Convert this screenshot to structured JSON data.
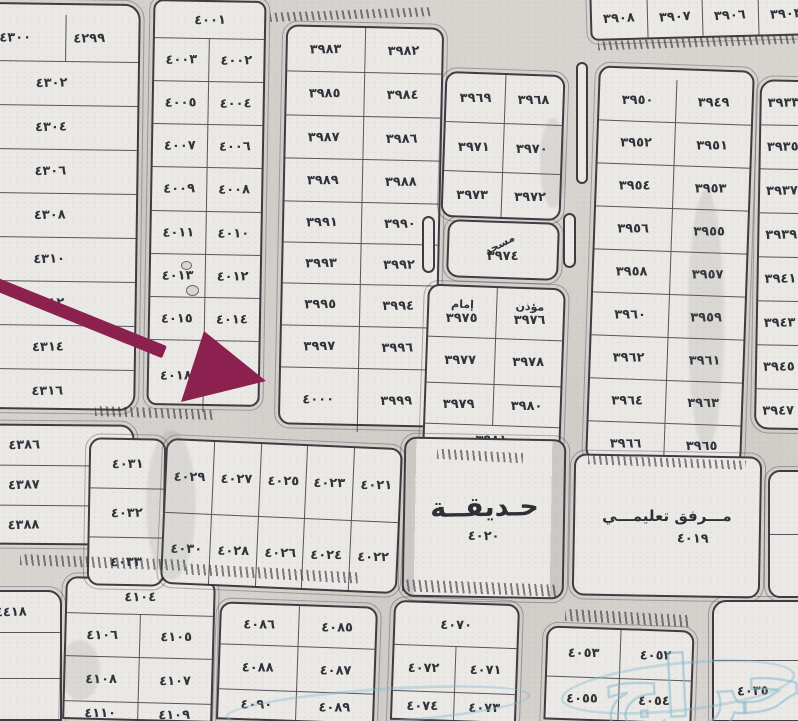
{
  "map": {
    "colors": {
      "paper": "#d8d5d1",
      "block_fill": "#ebe9e6",
      "line": "#3e3c42",
      "text": "#33323a",
      "arrow": "#8c2150",
      "watermark": "#85bccd"
    },
    "watermark": {
      "text": "حراج"
    },
    "arrow": {
      "line": {
        "x": -8,
        "y": 276,
        "len": 186,
        "w": 13,
        "deg": 22
      },
      "head_points": "204,331 181,402 266,381"
    },
    "blocks": [
      {
        "nm": "block-4300s-left",
        "x": -12,
        "y": 3,
        "w": 150,
        "h": 407,
        "tilt": 0.8,
        "pt": 10,
        "pr": 26,
        "r": "0 16px 16px 0",
        "rows": [
          {
            "h": 46,
            "c": [
              "٤٣٠٠",
              "٤٢٩٩"
            ]
          },
          {
            "h": 43,
            "c": [
              "٤٣٠٢"
            ]
          },
          {
            "h": 43,
            "c": [
              "٤٣٠٤"
            ]
          },
          {
            "h": 43,
            "c": [
              "٤٣٠٦"
            ]
          },
          {
            "h": 43,
            "c": [
              "٤٣٠٨"
            ]
          },
          {
            "h": 43,
            "c": [
              "٤٣١٠"
            ]
          },
          {
            "h": 43,
            "c": [
              "٤٣١٢"
            ]
          },
          {
            "h": 43,
            "c": [
              "٤٣١٤"
            ]
          },
          {
            "h": 43,
            "c": [
              "٤٣١٦"
            ]
          }
        ]
      },
      {
        "nm": "block-4380s-left",
        "x": -40,
        "y": 424,
        "w": 174,
        "h": 121,
        "pr": 46,
        "r": "0 14px 14px 0",
        "tilt": 0.5,
        "rows": [
          {
            "h": 39,
            "c": [
              "٤٣٨٦"
            ]
          },
          {
            "h": 39,
            "c": [
              "٤٣٨٧"
            ]
          },
          {
            "h": 39,
            "c": [
              "٤٣٨٨"
            ]
          }
        ]
      },
      {
        "nm": "block-4410s-left",
        "x": -40,
        "y": 590,
        "w": 102,
        "h": 131,
        "r": "0 14px 0 0",
        "rows": [
          {
            "h": 40,
            "c": [
              "٤٤١٨"
            ]
          },
          {
            "h": 45,
            "c": [
              ""
            ]
          },
          {
            "h": 46,
            "c": [
              ""
            ]
          }
        ]
      },
      {
        "nm": "block-4100s-bottom-left",
        "x": 64,
        "y": 578,
        "w": 150,
        "h": 143,
        "tilt": 1.5,
        "r": "12px 12px 0 0",
        "rows": [
          {
            "h": 34,
            "c": [
              "٤١٠٤"
            ]
          },
          {
            "h": 42,
            "c": [
              "٤١٠٦",
              "٤١٠٥"
            ]
          },
          {
            "h": 44,
            "c": [
              "٤١٠٨",
              "٤١٠٧"
            ]
          },
          {
            "h": 23,
            "c": [
              "٤١١٠",
              "٤١٠٩"
            ]
          }
        ]
      },
      {
        "nm": "block-4000s",
        "x": 150,
        "y": 0,
        "w": 113,
        "h": 406,
        "tilt": 1,
        "r": "10px",
        "rows": [
          {
            "h": 36,
            "c": [
              "٤٠٠١"
            ]
          },
          {
            "h": 42,
            "c": [
              "٤٠٠٣",
              "٤٠٠٢"
            ]
          },
          {
            "h": 42,
            "c": [
              "٤٠٠٥",
              "٤٠٠٤"
            ]
          },
          {
            "h": 42,
            "c": [
              "٤٠٠٧",
              "٤٠٠٦"
            ]
          },
          {
            "h": 43,
            "c": [
              "٤٠٠٩",
              "٤٠٠٨"
            ]
          },
          {
            "h": 42,
            "c": [
              "٤٠١١",
              "٤٠١٠"
            ]
          },
          {
            "h": 42,
            "c": [
              "٤٠١٣",
              "٤٠١٢"
            ]
          },
          {
            "h": 42,
            "c": [
              "٤٠١٥",
              "٤٠١٤"
            ]
          },
          {
            "h": 71,
            "c": [
              "٤٠١٨",
              "٤٠١٧"
            ]
          }
        ]
      },
      {
        "nm": "block-4030s-column",
        "x": 88,
        "y": 438,
        "w": 77,
        "h": 148,
        "tilt": 1,
        "rows": [
          {
            "h": 48,
            "c": [
              "٤٠٣١"
            ]
          },
          {
            "h": 48,
            "c": [
              "٤٠٣٢"
            ]
          },
          {
            "h": 48,
            "c": [
              "٤٠٣٣"
            ]
          }
        ]
      },
      {
        "nm": "block-3980s-3990s",
        "x": 282,
        "y": 26,
        "w": 158,
        "h": 400,
        "tilt": 1.2,
        "r": "12px",
        "rows": [
          {
            "h": 44,
            "c": [
              "٣٩٨٣",
              "٣٩٨٢"
            ]
          },
          {
            "h": 43,
            "c": [
              "٣٩٨٥",
              "٣٩٨٤"
            ]
          },
          {
            "h": 42,
            "c": [
              "٣٩٨٧",
              "٣٩٨٦"
            ]
          },
          {
            "h": 42,
            "c": [
              "٣٩٨٩",
              "٣٩٨٨"
            ]
          },
          {
            "h": 40,
            "c": [
              "٣٩٩١",
              "٣٩٩٠"
            ]
          },
          {
            "h": 40,
            "c": [
              "٣٩٩٣",
              "٣٩٩٢"
            ]
          },
          {
            "h": 41,
            "c": [
              "٣٩٩٥",
              "٣٩٩٤"
            ]
          },
          {
            "h": 41,
            "c": [
              "٣٩٩٧",
              "٣٩٩٦"
            ]
          },
          {
            "h": 63,
            "c": [
              {
                "n": "٤٠٠٠",
                "target": true
              },
              "٣٩٩٩"
            ]
          }
        ]
      },
      {
        "nm": "block-4020s-grid",
        "x": 163,
        "y": 443,
        "w": 237,
        "h": 146,
        "tilt": 2.5,
        "rows": [
          {
            "h": 72,
            "c": [
              "٤٠٢٩",
              "٤٠٢٧",
              "٤٠٢٥",
              "٤٠٢٣",
              "٤٠٢١"
            ]
          },
          {
            "h": 70,
            "c": [
              "٤٠٣٠",
              "٤٠٢٨",
              "٤٠٢٦",
              "٤٠٢٤",
              "٤٠٢٢"
            ]
          }
        ]
      },
      {
        "nm": "block-3960s-center",
        "x": 443,
        "y": 73,
        "w": 120,
        "h": 146,
        "tilt": 2,
        "rows": [
          {
            "h": 48,
            "c": [
              "٣٩٦٩",
              "٣٩٦٨"
            ]
          },
          {
            "h": 48,
            "c": [
              "٣٩٧١",
              "٣٩٧٠"
            ]
          },
          {
            "h": 46,
            "c": [
              "٣٩٧٣",
              "٣٩٧٢"
            ]
          }
        ]
      },
      {
        "nm": "mosque-block",
        "x": 447,
        "y": 221,
        "w": 112,
        "h": 58,
        "tilt": 2,
        "rows": [
          {
            "h": 54,
            "c": [
              {
                "n": "٣٩٧٤",
                "t": "مسجد",
                "diag": true
              }
            ]
          }
        ]
      },
      {
        "nm": "imam-muezzin-block",
        "x": 425,
        "y": 286,
        "w": 138,
        "h": 168,
        "tilt": 2,
        "rows": [
          {
            "h": 50,
            "c": [
              {
                "n": "٣٩٧٥",
                "t": "إمام"
              },
              {
                "n": "٣٩٧٦",
                "t": "مؤذن"
              }
            ]
          },
          {
            "h": 45,
            "c": [
              "٣٩٧٧",
              "٣٩٧٨"
            ]
          },
          {
            "h": 40,
            "c": [
              "٣٩٧٩",
              "٣٩٨٠"
            ]
          },
          {
            "h": 28,
            "c": [
              "٣٩٨١"
            ]
          }
        ]
      },
      {
        "nm": "block-3950s-3960s-right",
        "x": 592,
        "y": 68,
        "w": 156,
        "h": 395,
        "tilt": 2,
        "pt": 10,
        "rows": [
          {
            "h": 42,
            "c": [
              "٣٩٥٠",
              "٣٩٤٩"
            ]
          },
          {
            "h": 42,
            "c": [
              "٣٩٥٢",
              "٣٩٥١"
            ]
          },
          {
            "h": 42,
            "c": [
              "٣٩٥٤",
              "٣٩٥٣"
            ]
          },
          {
            "h": 42,
            "c": [
              "٣٩٥٦",
              "٣٩٥٥"
            ]
          },
          {
            "h": 42,
            "c": [
              "٣٩٥٨",
              "٣٩٥٧"
            ]
          },
          {
            "h": 42,
            "c": [
              "٣٩٦٠",
              "٣٩٥٩"
            ]
          },
          {
            "h": 42,
            "c": [
              "٣٩٦٢",
              "٣٩٦١"
            ]
          },
          {
            "h": 42,
            "c": [
              "٣٩٦٤",
              "٣٩٦٣"
            ]
          },
          {
            "h": 42,
            "c": [
              "٣٩٦٦",
              "٣٩٦٥"
            ]
          }
        ]
      },
      {
        "nm": "block-3940s-edge-column",
        "x": 757,
        "y": 80,
        "w": 85,
        "h": 350,
        "tilt": 1,
        "align": "left",
        "r": "14px 0 0 14px",
        "rows": [
          {
            "h": 43,
            "c": [
              "٣٩٣٣"
            ]
          },
          {
            "h": 43,
            "c": [
              "٣٩٣٥"
            ]
          },
          {
            "h": 43,
            "c": [
              "٣٩٣٧"
            ]
          },
          {
            "h": 43,
            "c": [
              "٣٩٣٩"
            ]
          },
          {
            "h": 43,
            "c": [
              "٣٩٤١"
            ]
          },
          {
            "h": 43,
            "c": [
              "٣٩٤٣"
            ]
          },
          {
            "h": 43,
            "c": [
              "٣٩٤٥"
            ]
          },
          {
            "h": 43,
            "c": [
              "٣٩٤٧"
            ]
          }
        ]
      },
      {
        "nm": "block-3900s-top-strip",
        "x": 590,
        "y": -6,
        "w": 225,
        "h": 44,
        "tilt": -1.5,
        "r": "0 0 8px 8px",
        "rows": [
          {
            "h": 40,
            "c": [
              "٣٩٠٨",
              "٣٩٠٧",
              "٣٩٠٦",
              "٣٩٠٣"
            ]
          }
        ]
      },
      {
        "nm": "garden-area",
        "x": 403,
        "y": 438,
        "w": 162,
        "h": 160,
        "tilt": 1,
        "cls": "garden",
        "title": "حـديقــة",
        "n": "٤٠٢٠"
      },
      {
        "nm": "education-facility-block",
        "x": 573,
        "y": 455,
        "w": 188,
        "h": 142,
        "tilt": 1,
        "cls": "edu",
        "title": "مـــرفق تعليمـــي",
        "n": "٤٠١٩"
      },
      {
        "nm": "partial-right-edge-block",
        "x": 768,
        "y": 470,
        "w": 56,
        "h": 128,
        "r": "12px 0 0 12px",
        "rows": [
          {
            "h": 62,
            "c": [
              ""
            ]
          },
          {
            "h": 60,
            "c": [
              ""
            ]
          }
        ]
      },
      {
        "nm": "block-4080s-bottom",
        "x": 218,
        "y": 604,
        "w": 158,
        "h": 118,
        "tilt": 2,
        "r": "12px 12px 0 0",
        "rows": [
          {
            "h": 40,
            "c": [
              "٤٠٨٦",
              "٤٠٨٥"
            ]
          },
          {
            "h": 44,
            "c": [
              "٤٠٨٨",
              "٤٠٨٧"
            ]
          },
          {
            "h": 28,
            "c": [
              "٤٠٩٠",
              "٤٠٨٩"
            ]
          }
        ]
      },
      {
        "nm": "block-4070s-bottom",
        "x": 392,
        "y": 602,
        "w": 126,
        "h": 120,
        "tilt": 2,
        "r": "12px 12px 0 0",
        "rows": [
          {
            "h": 42,
            "c": [
              "٤٠٧٠"
            ]
          },
          {
            "h": 45,
            "c": [
              "٤٠٧٢",
              "٤٠٧١"
            ]
          },
          {
            "h": 28,
            "c": [
              "٤٠٧٤",
              "٤٠٧٣"
            ]
          }
        ]
      },
      {
        "nm": "block-4050s-bottom",
        "x": 545,
        "y": 628,
        "w": 148,
        "h": 94,
        "tilt": 2,
        "r": "12px 12px 0 0",
        "rows": [
          {
            "h": 48,
            "c": [
              "٤٠٥٣",
              "٤٠٥٢"
            ]
          },
          {
            "h": 42,
            "c": [
              "٤٠٥٥",
              "٤٠٥٤"
            ]
          }
        ]
      },
      {
        "nm": "block-4035-bottom-right",
        "x": 712,
        "y": 600,
        "w": 112,
        "h": 122,
        "pr": 30,
        "r": "14px 0 0 0",
        "rows": [
          {
            "h": 58,
            "c": [
              ""
            ]
          },
          {
            "h": 60,
            "c": [
              "٤٠٣٥"
            ]
          }
        ]
      }
    ],
    "hatches": [
      {
        "x": 270,
        "y": 10,
        "w": 162,
        "h": 9,
        "deg": -2
      },
      {
        "x": 598,
        "y": 38,
        "w": 200,
        "h": 9,
        "deg": -2
      },
      {
        "x": 95,
        "y": 408,
        "w": 118,
        "h": 10,
        "deg": 2
      },
      {
        "x": 588,
        "y": 458,
        "w": 158,
        "h": 9,
        "deg": 2
      },
      {
        "x": 437,
        "y": 451,
        "w": 86,
        "h": 10,
        "deg": 3
      },
      {
        "x": 20,
        "y": 557,
        "w": 168,
        "h": 11,
        "deg": 2
      },
      {
        "x": 186,
        "y": 568,
        "w": 172,
        "h": 11,
        "deg": 3
      },
      {
        "x": 402,
        "y": 582,
        "w": 156,
        "h": 12,
        "deg": 2
      },
      {
        "x": 565,
        "y": 612,
        "w": 125,
        "h": 12,
        "deg": 3
      }
    ],
    "medians": [
      {
        "x": 422,
        "y": 216,
        "w": 13,
        "h": 57
      },
      {
        "x": 563,
        "y": 213,
        "w": 13,
        "h": 55
      },
      {
        "x": 576,
        "y": 62,
        "w": 12,
        "h": 122
      }
    ],
    "stones": [
      {
        "x": 181,
        "y": 261,
        "w": 11,
        "h": 9
      },
      {
        "x": 186,
        "y": 285,
        "w": 13,
        "h": 11
      }
    ],
    "smudges": [
      {
        "x": 146,
        "y": 430,
        "w": 50,
        "h": 150
      },
      {
        "x": 688,
        "y": 190,
        "w": 36,
        "h": 260
      },
      {
        "x": 540,
        "y": 118,
        "w": 26,
        "h": 90
      },
      {
        "x": 60,
        "y": 640,
        "w": 40,
        "h": 60
      }
    ],
    "swooshes": [
      {
        "x": 225,
        "y": 688,
        "w": 300,
        "h": 30,
        "deg": -4
      },
      {
        "x": 560,
        "y": 662,
        "w": 230,
        "h": 44,
        "deg": -6
      }
    ]
  }
}
